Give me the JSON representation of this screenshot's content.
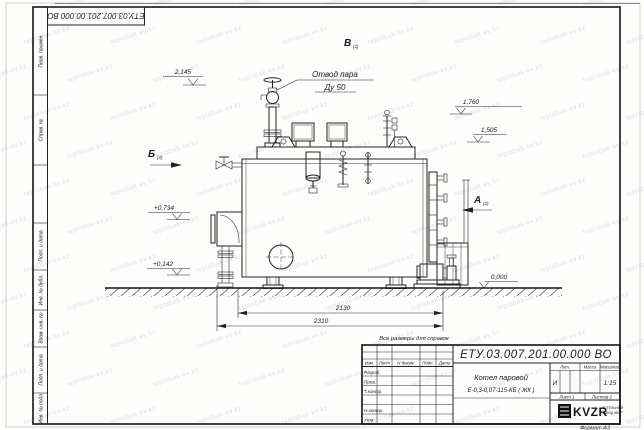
{
  "frame": {
    "doc_number": "ЕТУ.03.007.201.00.000  ВО",
    "format_label": "Формат А3",
    "side_cells": [
      "Перв. примен.",
      "Справ. №",
      "Подп. и дата",
      "Инв. № дубл.",
      "Взам. инв. №",
      "Подп. и дата",
      "Инв. № подл."
    ]
  },
  "title_block": {
    "doc_number": "ЕТУ.03.007.201.00.000  ВО",
    "columns": [
      "Изм.",
      "Лист",
      "N докум.",
      "Подп.",
      "Дата"
    ],
    "rows": [
      "Разраб.",
      "Пров.",
      "Т.контр.",
      "Н.контр.",
      "Утв."
    ],
    "product_name": "Котел паровой",
    "product_model": "Е-0,3-0,07-115-КБ ( ЖК )",
    "lit_header": "Лит.",
    "mass_header": "Масса",
    "scale_header": "Масштаб",
    "lit_value": "И",
    "scale_value": "1:15",
    "sheet_label": "Лист 1",
    "sheets_label": "Листов 2",
    "logo_text": "KVZR",
    "logo_caption_1": "КОТЕЛЬНЫЙ",
    "logo_caption_2": "ЗАВОД КВЗР"
  },
  "notes": {
    "reference_note": "Все размеры для справок"
  },
  "drawing": {
    "callout": {
      "line1": "Отвод пара",
      "line2": "Ду 50"
    },
    "views": {
      "b": {
        "label": "Б",
        "sub": "(2)"
      },
      "a": {
        "label": "А",
        "sub": "(2)"
      },
      "v": {
        "label": "В",
        "sub": "(2)"
      }
    },
    "levels": {
      "l2145": "2,145",
      "l1760": "1,760",
      "l1505": "1,505",
      "l0734": "+0,734",
      "l0142": "+0,142",
      "l0000": "0,000"
    },
    "dims": {
      "d2130": "2130",
      "d2310": "2310"
    }
  },
  "watermark": {
    "text": "teplobak-kv.kz"
  }
}
